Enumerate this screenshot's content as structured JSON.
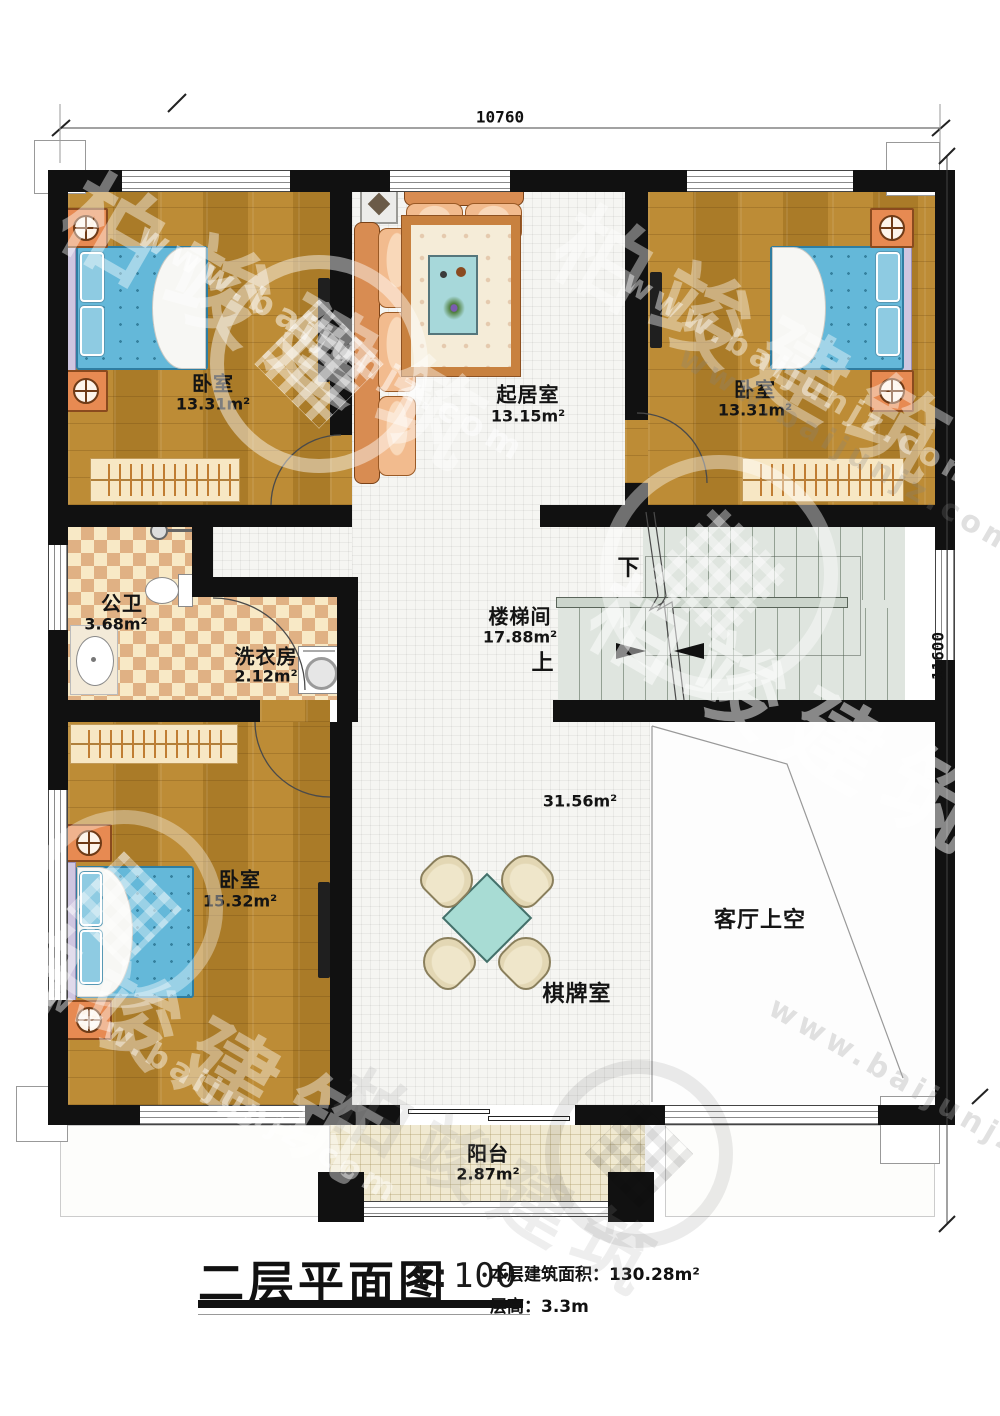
{
  "dimensions": {
    "top_width": "10760",
    "right_height": "11600"
  },
  "rooms": {
    "bedroom_nw": {
      "name": "卧室",
      "area": "13.31m²"
    },
    "living": {
      "name": "起居室",
      "area": "13.15m²"
    },
    "bedroom_ne": {
      "name": "卧室",
      "area": "13.31m²"
    },
    "bathroom": {
      "name": "公卫",
      "area": "3.68m²"
    },
    "laundry": {
      "name": "洗衣房",
      "area": "2.12m²"
    },
    "stairwell": {
      "name": "楼梯间",
      "area": "17.88m²",
      "down_label": "下",
      "up_label": "上"
    },
    "bedroom_sw": {
      "name": "卧室",
      "area": "15.32m²"
    },
    "game_room": {
      "name": "棋牌室",
      "area": "31.56m²"
    },
    "living_void": {
      "name": "客厅上空"
    },
    "balcony": {
      "name": "阳台",
      "area": "2.87m²"
    }
  },
  "title_block": {
    "title": "二层平面图",
    "scale": "1:100",
    "floor_area_label": "本层建筑面积：",
    "floor_area_value": "130.28m²",
    "floor_height_label": "层高：",
    "floor_height_value": "3.3m"
  },
  "watermark": {
    "brand": "柏竣建筑",
    "website": "www.baijunjz.com"
  },
  "colors": {
    "wall": "#111111",
    "wood_floor": "#b5842e",
    "tile_floor": "#f5f5f2",
    "bath_tile": "#e0b184",
    "stair_floor": "#dfe5df",
    "balcony_floor": "#f0e9d1",
    "bed_blue": "#64b8d9",
    "sofa_peach": "#f2bb8e",
    "game_table_teal": "#a8dcd4",
    "nightstand_orange": "#e78a52"
  }
}
